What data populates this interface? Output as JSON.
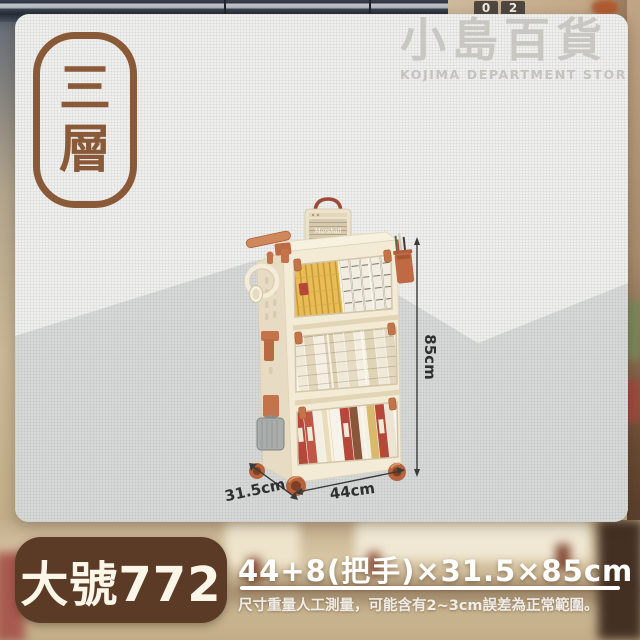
{
  "colors": {
    "accent_brown": "#8a5a38",
    "footer_badge_brown": "#5b3a26",
    "card_light_gray": "#efefed",
    "card_shade_gray": "#d7d9d8",
    "terracotta": "#c5734a",
    "product_cream": "#f3ebd6",
    "text_white": "#ffffff"
  },
  "tier_badge": {
    "char1": "三",
    "char2": "層"
  },
  "watermark": {
    "title": "小島百貨",
    "subtitle": "KOJIMA DEPARTMENT STORE"
  },
  "background": {
    "clock_digit1": "0",
    "clock_digit2": "2"
  },
  "product": {
    "speaker_brand": "Marshall",
    "height_label": "85cm",
    "width_label": "44cm",
    "depth_label": "31.5cm"
  },
  "footer": {
    "size_badge": "大號772",
    "dimensions": "44+8(把手)×31.5×85cm",
    "disclaimer": "尺寸重量人工測量，可能含有2~3cm誤差為正常範圍。"
  }
}
